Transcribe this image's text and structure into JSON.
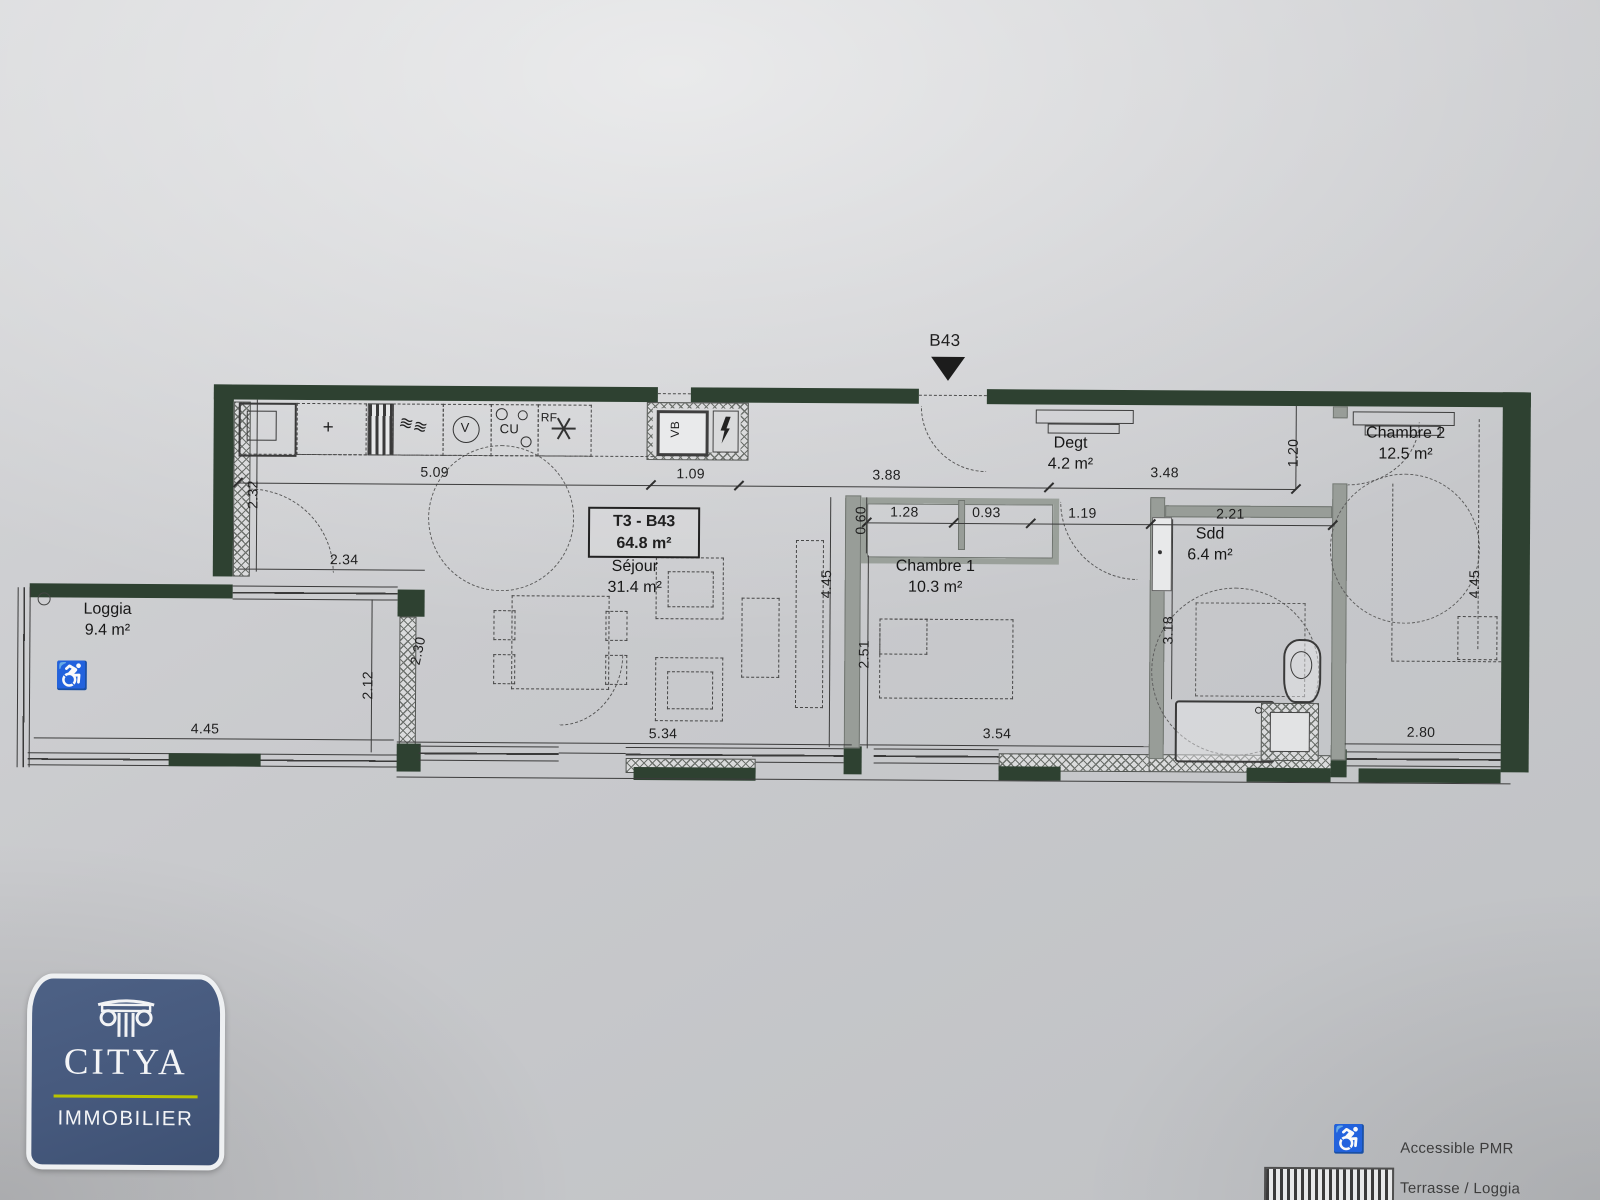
{
  "unit": {
    "label": "B43"
  },
  "title_box": {
    "line1": "T3 - B43",
    "line2": "64.8 m²"
  },
  "rooms": {
    "sejour": {
      "name": "Séjour",
      "area": "31.4 m²"
    },
    "loggia": {
      "name": "Loggia",
      "area": "9.4 m²"
    },
    "degt": {
      "name": "Degt",
      "area": "4.2 m²"
    },
    "chambre1": {
      "name": "Chambre 1",
      "area": "10.3 m²"
    },
    "chambre2": {
      "name": "Chambre 2",
      "area": "12.5 m²"
    },
    "sdd": {
      "name": "Sdd",
      "area": "6.4 m²"
    }
  },
  "kitchen": {
    "vb": "VB",
    "cu": "CU",
    "rf": "RF",
    "v": "V",
    "faucet": "+"
  },
  "dims": {
    "top": [
      "5.09",
      "1.09",
      "3.88",
      "3.48"
    ],
    "v120": "1.20",
    "v232": "2.32",
    "h234": "2.34",
    "v060": "0.60",
    "mid": [
      "1.28",
      "0.93",
      "1.19",
      "2.21"
    ],
    "v230": "2.30",
    "v212": "2.12",
    "v445_sejour": "4.45",
    "v251": "2.51",
    "v318": "3.18",
    "v445_ch2": "4.45",
    "bottom": [
      "4.45",
      "5.34",
      "3.54",
      "2.80"
    ]
  },
  "legend": {
    "accessible": "Accessible PMR",
    "terrasse": "Terrasse / Loggia"
  },
  "logo": {
    "brand": "CITYA",
    "tagline": "IMMOBILIER"
  },
  "colors": {
    "wall": "#2e4131",
    "paper": "#c6c8ca",
    "logo_blue": "#46597d",
    "logo_accent": "#b9c400"
  }
}
